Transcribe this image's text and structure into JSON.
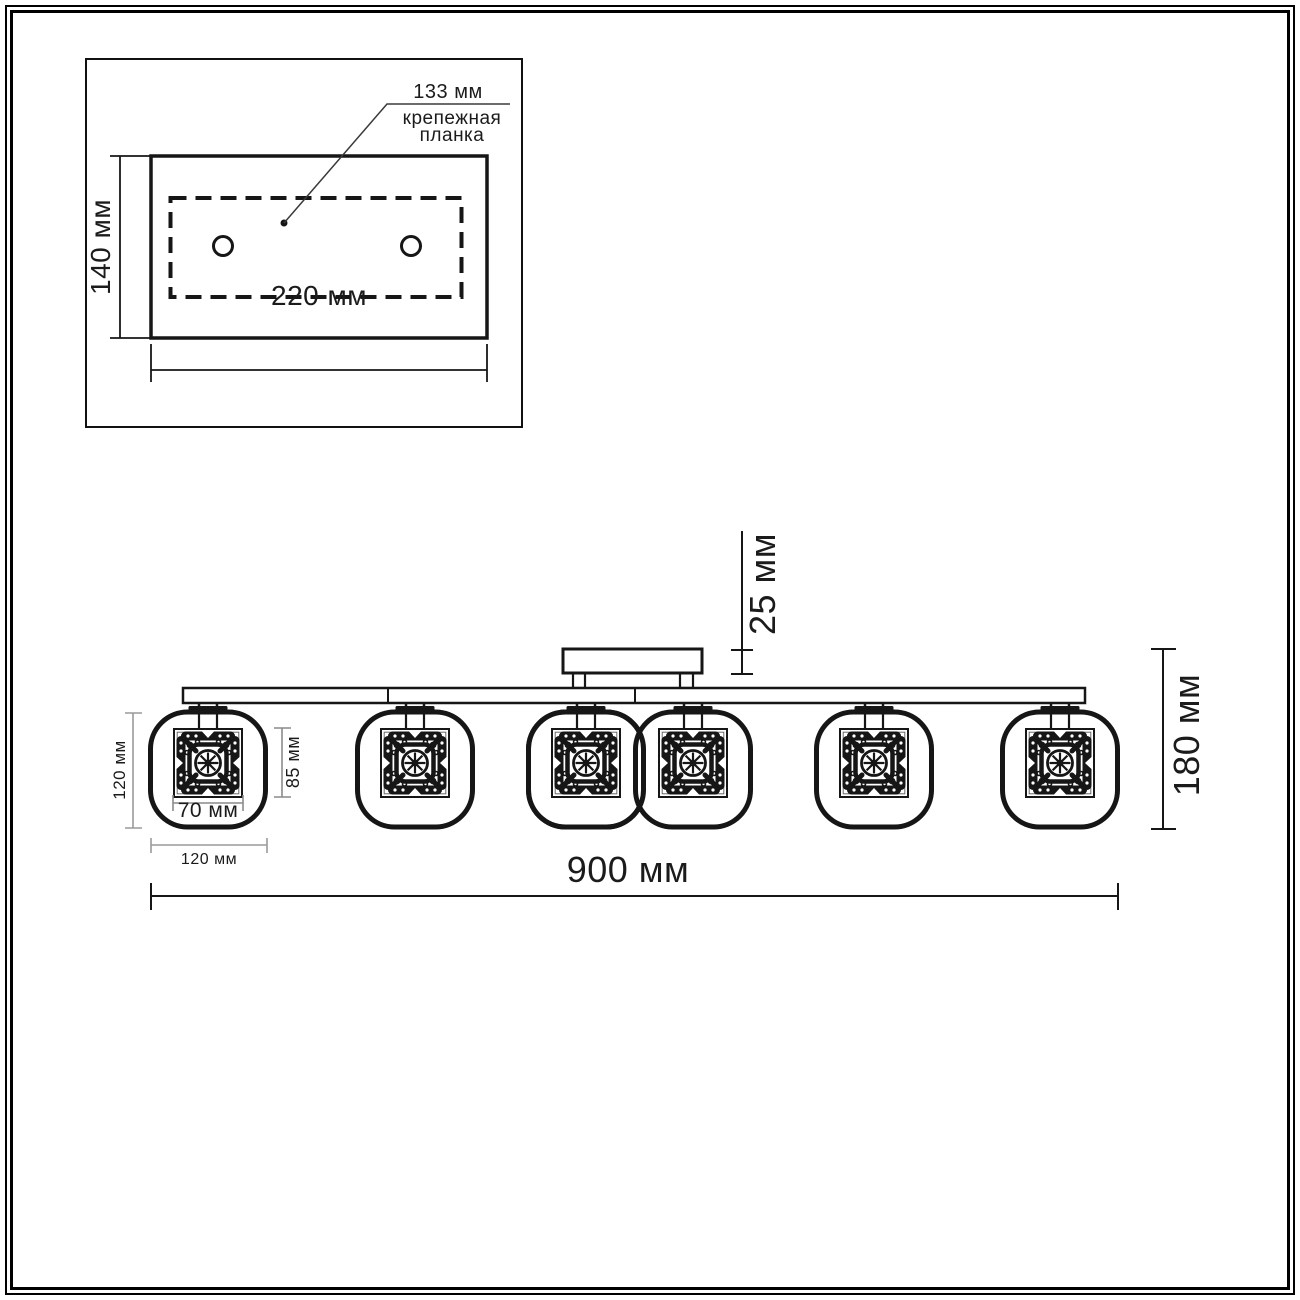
{
  "inset": {
    "plate_width_label": "133 мм",
    "plate_caption": "крепежная планка",
    "height_label": "140 мм",
    "width_label": "220 мм",
    "mounting_hole_count": 2
  },
  "front_view": {
    "canopy_height_label": "25 мм",
    "total_height_label": "180 мм",
    "total_width_label": "900 мм",
    "shade_height_label": "120 мм",
    "shade_width_label": "120 мм",
    "decor_insert_height_label": "85 мм",
    "decor_insert_width_label": "70 мм",
    "lamp_count": 6
  },
  "colors": {
    "line": "#161616",
    "dim_line_small": "#9a9a9a",
    "background": "#ffffff"
  }
}
